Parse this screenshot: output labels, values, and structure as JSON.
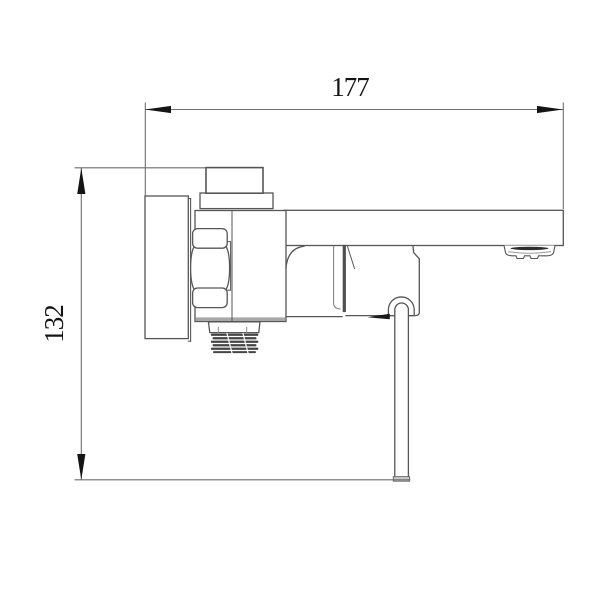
{
  "drawing": {
    "figure": "bath-mixer-faucet-side-view-technical-drawing",
    "units_shown": false
  },
  "dimensions": {
    "width": {
      "label": "177"
    },
    "height": {
      "label": "132"
    }
  },
  "colors": {
    "background": "#ffffff",
    "outline": "#565656",
    "dimension_line": "#6e6e6e",
    "ink": "#141414",
    "thread": "#454545",
    "body_shade": "#a8a8a8",
    "handle_cap": "#c9c9c9",
    "aerator_slot": "#2e2e2e"
  }
}
